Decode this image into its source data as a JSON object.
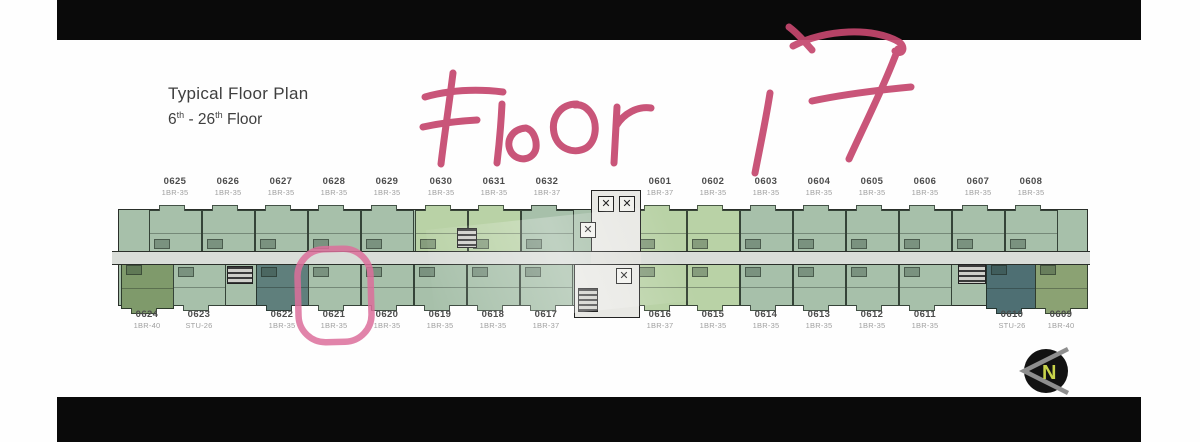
{
  "letterbox": {
    "color": "#0a0a0a"
  },
  "title": {
    "line1": "Typical Floor Plan",
    "floor_from": "6",
    "sup1": "th",
    "dash": " - ",
    "floor_to": "26",
    "sup2": "th",
    "floor_word": " Floor"
  },
  "annotation": {
    "handwriting": "Floor 17",
    "ink_color": "#c5476e",
    "circle_color": "#dc6f9b",
    "circled_unit": "0621"
  },
  "compass": {
    "label": "N",
    "label_color": "#c9d44b",
    "arrow_color": "#8e8e8e",
    "bg": "#121212"
  },
  "floorplan": {
    "palette": {
      "unit_green": "#a7c0aa",
      "unit_light": "#b9d2a6",
      "corridor": "#d9ddd8",
      "core": "#e8e8e4",
      "teal": "#5f7f7c",
      "teal_dark": "#4e6f73",
      "olive": "#7f9a6b",
      "olive_light": "#8ba273",
      "outline": "#2a2f2a"
    },
    "icons": {
      "elevator": "✕"
    },
    "top_row": [
      {
        "unit": "0625",
        "type": "1BR-35",
        "x": 175
      },
      {
        "unit": "0626",
        "type": "1BR-35",
        "x": 228
      },
      {
        "unit": "0627",
        "type": "1BR-35",
        "x": 281
      },
      {
        "unit": "0628",
        "type": "1BR-35",
        "x": 334
      },
      {
        "unit": "0629",
        "type": "1BR-35",
        "x": 387
      },
      {
        "unit": "0630",
        "type": "1BR-35",
        "x": 441,
        "shade": "light"
      },
      {
        "unit": "0631",
        "type": "1BR-35",
        "x": 494,
        "shade": "light"
      },
      {
        "unit": "0632",
        "type": "1BR-37",
        "x": 547
      },
      {
        "unit": "0601",
        "type": "1BR-37",
        "x": 660,
        "shade": "light"
      },
      {
        "unit": "0602",
        "type": "1BR-35",
        "x": 713,
        "shade": "light"
      },
      {
        "unit": "0603",
        "type": "1BR-35",
        "x": 766
      },
      {
        "unit": "0604",
        "type": "1BR-35",
        "x": 819
      },
      {
        "unit": "0605",
        "type": "1BR-35",
        "x": 872
      },
      {
        "unit": "0606",
        "type": "1BR-35",
        "x": 925
      },
      {
        "unit": "0607",
        "type": "1BR-35",
        "x": 978
      },
      {
        "unit": "0608",
        "type": "1BR-35",
        "x": 1031
      }
    ],
    "bottom_row": [
      {
        "unit": "0624",
        "type": "1BR-40",
        "x": 147,
        "color": "#7f9a6b",
        "tall": true
      },
      {
        "unit": "0623",
        "type": "STU-26",
        "x": 199
      },
      {
        "unit": "0622",
        "type": "1BR-35",
        "x": 282,
        "color": "#5f7f7c"
      },
      {
        "unit": "0621",
        "type": "1BR-35",
        "x": 334
      },
      {
        "unit": "0620",
        "type": "1BR-35",
        "x": 387
      },
      {
        "unit": "0619",
        "type": "1BR-35",
        "x": 440
      },
      {
        "unit": "0618",
        "type": "1BR-35",
        "x": 493
      },
      {
        "unit": "0617",
        "type": "1BR-37",
        "x": 546
      },
      {
        "unit": "0616",
        "type": "1BR-37",
        "x": 660,
        "shade": "light"
      },
      {
        "unit": "0615",
        "type": "1BR-35",
        "x": 713,
        "shade": "light"
      },
      {
        "unit": "0614",
        "type": "1BR-35",
        "x": 766
      },
      {
        "unit": "0613",
        "type": "1BR-35",
        "x": 819
      },
      {
        "unit": "0612",
        "type": "1BR-35",
        "x": 872
      },
      {
        "unit": "0611",
        "type": "1BR-35",
        "x": 925
      },
      {
        "unit": "0610",
        "type": "STU-26",
        "x": 1012,
        "color": "#4e6f73",
        "tall": true
      },
      {
        "unit": "0609",
        "type": "1BR-40",
        "x": 1061,
        "color": "#8ba273",
        "tall": true
      }
    ]
  }
}
